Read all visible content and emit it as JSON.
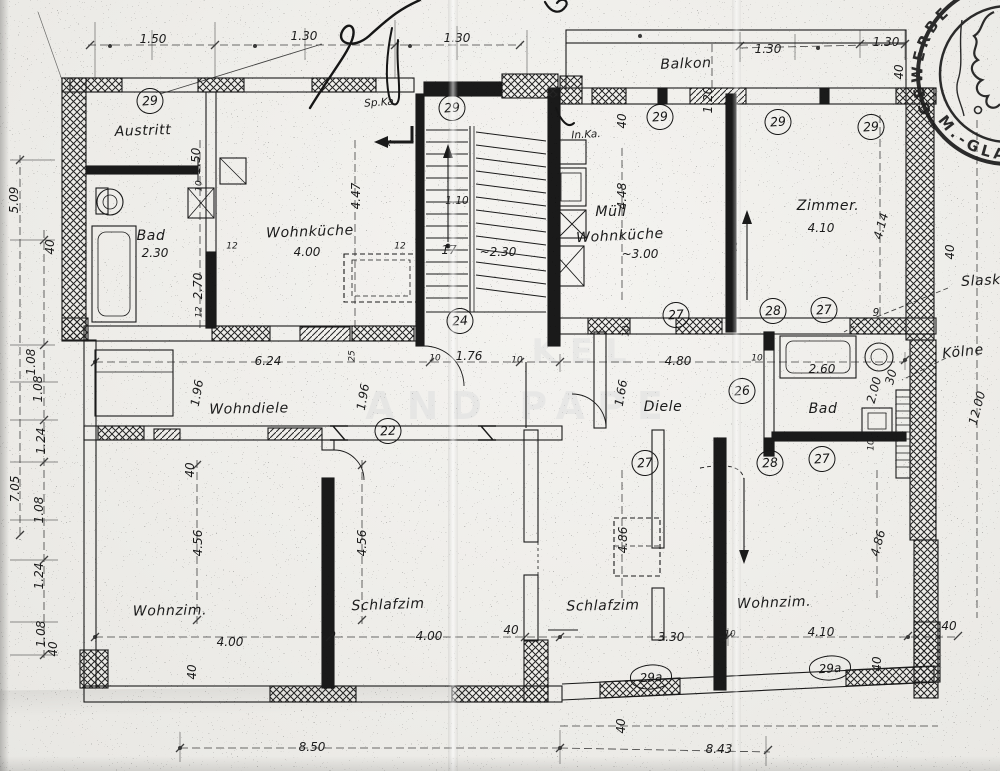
{
  "stamp": {
    "arc_top": "GEWERBE",
    "arc_bottom": "M.-GLA"
  },
  "watermark": [
    {
      "text": "KEL",
      "x": 585,
      "y": 352,
      "size": 34
    },
    {
      "text": "AND PAPE",
      "x": 520,
      "y": 406,
      "size": 38
    }
  ],
  "ref_circles": [
    {
      "text": "29",
      "x": 150,
      "y": 101
    },
    {
      "text": "29",
      "x": 452,
      "y": 108
    },
    {
      "text": "29",
      "x": 660,
      "y": 117
    },
    {
      "text": "29",
      "x": 778,
      "y": 122
    },
    {
      "text": "29",
      "x": 871,
      "y": 127
    },
    {
      "text": "24",
      "x": 460,
      "y": 321
    },
    {
      "text": "27",
      "x": 676,
      "y": 315
    },
    {
      "text": "28",
      "x": 773,
      "y": 311
    },
    {
      "text": "27",
      "x": 824,
      "y": 310
    },
    {
      "text": "22",
      "x": 388,
      "y": 431
    },
    {
      "text": "26",
      "x": 742,
      "y": 391
    },
    {
      "text": "27",
      "x": 645,
      "y": 463
    },
    {
      "text": "28",
      "x": 770,
      "y": 463
    },
    {
      "text": "27",
      "x": 822,
      "y": 459
    },
    {
      "text": "29a",
      "x": 651,
      "y": 677,
      "oval": true
    },
    {
      "text": "29a",
      "x": 830,
      "y": 668,
      "oval": true
    }
  ],
  "annotations": [
    {
      "text": "Austritt",
      "x": 143,
      "y": 131,
      "rot": -2,
      "cls": "room"
    },
    {
      "text": "Bad",
      "x": 151,
      "y": 236,
      "cls": "room"
    },
    {
      "text": "2.30",
      "x": 155,
      "y": 253
    },
    {
      "text": "Wohnküche",
      "x": 310,
      "y": 232,
      "rot": -2,
      "cls": "room"
    },
    {
      "text": "4.00",
      "x": 307,
      "y": 252
    },
    {
      "text": "Müll",
      "x": 611,
      "y": 212,
      "cls": "room"
    },
    {
      "text": "Wohnküche",
      "x": 620,
      "y": 236,
      "rot": -3,
      "cls": "room"
    },
    {
      "text": "~3.00",
      "x": 640,
      "y": 254
    },
    {
      "text": "Zimmer.",
      "x": 828,
      "y": 206,
      "cls": "room"
    },
    {
      "text": "4.10",
      "x": 821,
      "y": 228
    },
    {
      "text": "Balkon",
      "x": 686,
      "y": 64,
      "rot": -2,
      "cls": "room"
    },
    {
      "text": "Wohndiele",
      "x": 249,
      "y": 409,
      "rot": -1,
      "cls": "room"
    },
    {
      "text": "Diele",
      "x": 663,
      "y": 407,
      "cls": "room"
    },
    {
      "text": "Bad",
      "x": 823,
      "y": 409,
      "cls": "room"
    },
    {
      "text": "Wohnzim.",
      "x": 170,
      "y": 611,
      "rot": -1,
      "cls": "room"
    },
    {
      "text": "Schlafzim",
      "x": 388,
      "y": 605,
      "rot": -2,
      "cls": "room"
    },
    {
      "text": "Schlafzim",
      "x": 603,
      "y": 606,
      "rot": -1,
      "cls": "room"
    },
    {
      "text": "Wohnzim.",
      "x": 774,
      "y": 603,
      "rot": -2,
      "cls": "room"
    },
    {
      "text": "Sp.Ka",
      "x": 379,
      "y": 103,
      "rot": -4,
      "cls": "small"
    },
    {
      "text": "In.Ka.",
      "x": 586,
      "y": 135,
      "rot": -3,
      "cls": "small"
    },
    {
      "text": "Slask",
      "x": 981,
      "y": 281,
      "rot": -3,
      "cls": "room"
    },
    {
      "text": "Kölne",
      "x": 963,
      "y": 352,
      "rot": -6,
      "cls": "room"
    },
    {
      "text": "1.50",
      "x": 153,
      "y": 39
    },
    {
      "text": "1.30",
      "x": 304,
      "y": 36
    },
    {
      "text": "1.30",
      "x": 457,
      "y": 38
    },
    {
      "text": "1.20",
      "x": 708,
      "y": 100,
      "rot": -90
    },
    {
      "text": "1.30",
      "x": 768,
      "y": 49
    },
    {
      "text": "1.30",
      "x": 886,
      "y": 42
    },
    {
      "text": "40",
      "x": 899,
      "y": 72,
      "rot": -90
    },
    {
      "text": "40",
      "x": 622,
      "y": 121,
      "rot": -90
    },
    {
      "text": "5.09",
      "x": 14,
      "y": 200,
      "rot": -90
    },
    {
      "text": "40",
      "x": 50,
      "y": 247,
      "rot": -90
    },
    {
      "text": "1.08",
      "x": 31,
      "y": 362,
      "rot": -90
    },
    {
      "text": "1.08",
      "x": 38,
      "y": 389,
      "rot": -90
    },
    {
      "text": "1.24",
      "x": 41,
      "y": 441,
      "rot": -90
    },
    {
      "text": "7.05",
      "x": 15,
      "y": 489,
      "rot": -90
    },
    {
      "text": "1.08",
      "x": 39,
      "y": 510,
      "rot": -90
    },
    {
      "text": "1.24",
      "x": 39,
      "y": 576,
      "rot": -90
    },
    {
      "text": "1.08",
      "x": 41,
      "y": 634,
      "rot": -90
    },
    {
      "text": "40",
      "x": 53,
      "y": 649,
      "rot": -90
    },
    {
      "text": "1.50",
      "x": 196,
      "y": 161,
      "rot": -90
    },
    {
      "text": "10",
      "x": 200,
      "y": 186,
      "rot": -90,
      "cls": "tiny"
    },
    {
      "text": "2.70",
      "x": 198,
      "y": 286,
      "rot": -90
    },
    {
      "text": "12",
      "x": 200,
      "y": 312,
      "rot": -90,
      "cls": "tiny"
    },
    {
      "text": "12",
      "x": 232,
      "y": 247,
      "cls": "tiny"
    },
    {
      "text": "12",
      "x": 400,
      "y": 247,
      "cls": "tiny"
    },
    {
      "text": "4.47",
      "x": 356,
      "y": 196,
      "rot": -90
    },
    {
      "text": "1.10",
      "x": 457,
      "y": 201,
      "cls": "small"
    },
    {
      "text": "17",
      "x": 449,
      "y": 250
    },
    {
      "text": "~2.30",
      "x": 498,
      "y": 252
    },
    {
      "text": "4.48",
      "x": 622,
      "y": 196,
      "rot": -90
    },
    {
      "text": "x",
      "x": 388,
      "y": 143,
      "cls": "small"
    },
    {
      "text": "4.14",
      "x": 881,
      "y": 226,
      "rot": -75
    },
    {
      "text": "40",
      "x": 950,
      "y": 252,
      "rot": -90
    },
    {
      "text": "40",
      "x": 733,
      "y": 247,
      "rot": -90
    },
    {
      "text": "9",
      "x": 876,
      "y": 313,
      "cls": "small"
    },
    {
      "text": "6.24",
      "x": 268,
      "y": 361
    },
    {
      "text": "10",
      "x": 435,
      "y": 359,
      "cls": "tiny"
    },
    {
      "text": "1.76",
      "x": 469,
      "y": 356
    },
    {
      "text": "10",
      "x": 517,
      "y": 361,
      "cls": "tiny"
    },
    {
      "text": "4.80",
      "x": 678,
      "y": 361
    },
    {
      "text": "10",
      "x": 627,
      "y": 331,
      "rot": -90,
      "cls": "tiny"
    },
    {
      "text": "1.66",
      "x": 621,
      "y": 393,
      "rot": -80
    },
    {
      "text": "1.96",
      "x": 197,
      "y": 393,
      "rot": -80
    },
    {
      "text": "1.96",
      "x": 363,
      "y": 397,
      "rot": -80
    },
    {
      "text": "25",
      "x": 353,
      "y": 356,
      "rot": -90,
      "cls": "tiny"
    },
    {
      "text": "10",
      "x": 757,
      "y": 359,
      "cls": "tiny"
    },
    {
      "text": "2.60",
      "x": 822,
      "y": 369
    },
    {
      "text": "2.00",
      "x": 874,
      "y": 390,
      "rot": -75
    },
    {
      "text": "30",
      "x": 891,
      "y": 377,
      "rot": -75
    },
    {
      "text": "10",
      "x": 872,
      "y": 445,
      "rot": -90,
      "cls": "tiny"
    },
    {
      "text": "12.00",
      "x": 977,
      "y": 408,
      "rot": -75
    },
    {
      "text": "40",
      "x": 190,
      "y": 470,
      "rot": -90
    },
    {
      "text": "4.56",
      "x": 198,
      "y": 543,
      "rot": -90
    },
    {
      "text": "4.56",
      "x": 362,
      "y": 543,
      "rot": -90
    },
    {
      "text": "4.86",
      "x": 623,
      "y": 540,
      "rot": -90
    },
    {
      "text": "4.86",
      "x": 878,
      "y": 543,
      "rot": -75
    },
    {
      "text": "4.00",
      "x": 230,
      "y": 642
    },
    {
      "text": "10",
      "x": 330,
      "y": 636,
      "cls": "tiny"
    },
    {
      "text": "4.00",
      "x": 429,
      "y": 636
    },
    {
      "text": "40",
      "x": 511,
      "y": 630
    },
    {
      "text": "3.30",
      "x": 671,
      "y": 637
    },
    {
      "text": "10",
      "x": 730,
      "y": 635,
      "cls": "tiny"
    },
    {
      "text": "4.10",
      "x": 821,
      "y": 632
    },
    {
      "text": "40",
      "x": 949,
      "y": 626
    },
    {
      "text": "40",
      "x": 877,
      "y": 664,
      "rot": -90
    },
    {
      "text": "40",
      "x": 192,
      "y": 672,
      "rot": -90
    },
    {
      "text": "40",
      "x": 621,
      "y": 726,
      "rot": -90
    },
    {
      "text": "8.50",
      "x": 312,
      "y": 747
    },
    {
      "text": "8.43",
      "x": 719,
      "y": 749
    }
  ]
}
